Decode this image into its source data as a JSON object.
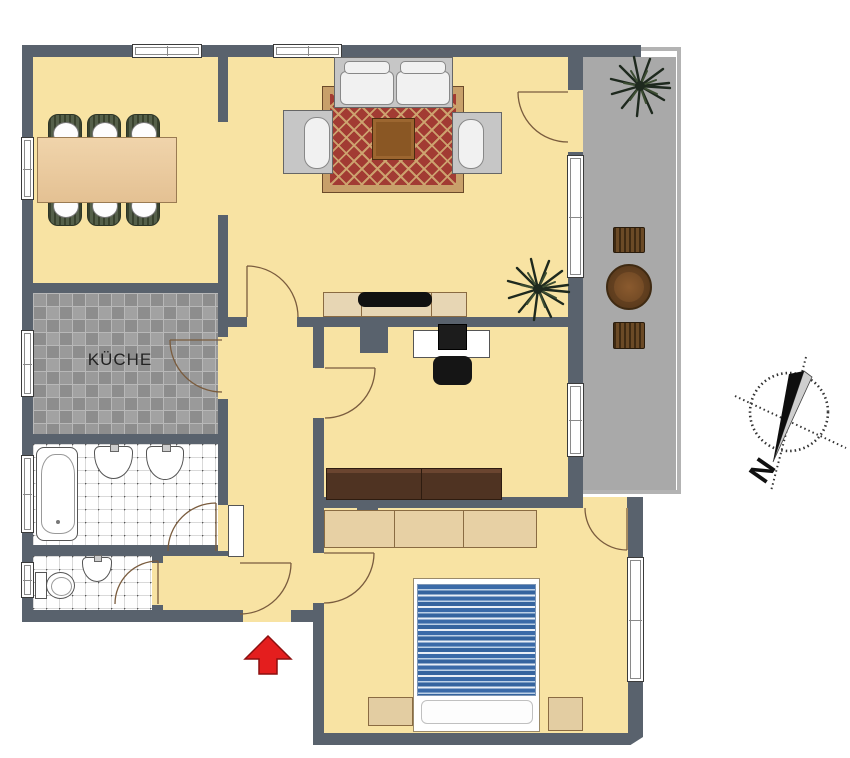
{
  "labels": {
    "kitchen": "KÜCHE",
    "compass_north": "N"
  },
  "colors": {
    "wall": "#59626d",
    "floor_yellow": "#f8e3a3",
    "balcony_gray": "#a9a9a9",
    "kitchen_tile_dark": "#8d8d8d",
    "kitchen_tile_light": "#a2a2a2",
    "bath_tile_white": "#ffffff",
    "rug_red": "#a23b33",
    "rug_border_tan": "#c8a06a",
    "bed_stripe_blue": "#3a6aa8",
    "sofa_gray": "#c6c6c6",
    "dining_table_wood": "#ecca9e",
    "coffee_table_wood": "#8a5724",
    "office_couch_brown": "#4f3322",
    "cabinet_tan": "#e7d6b4",
    "entrance_arrow_red": "#e41e1e"
  }
}
